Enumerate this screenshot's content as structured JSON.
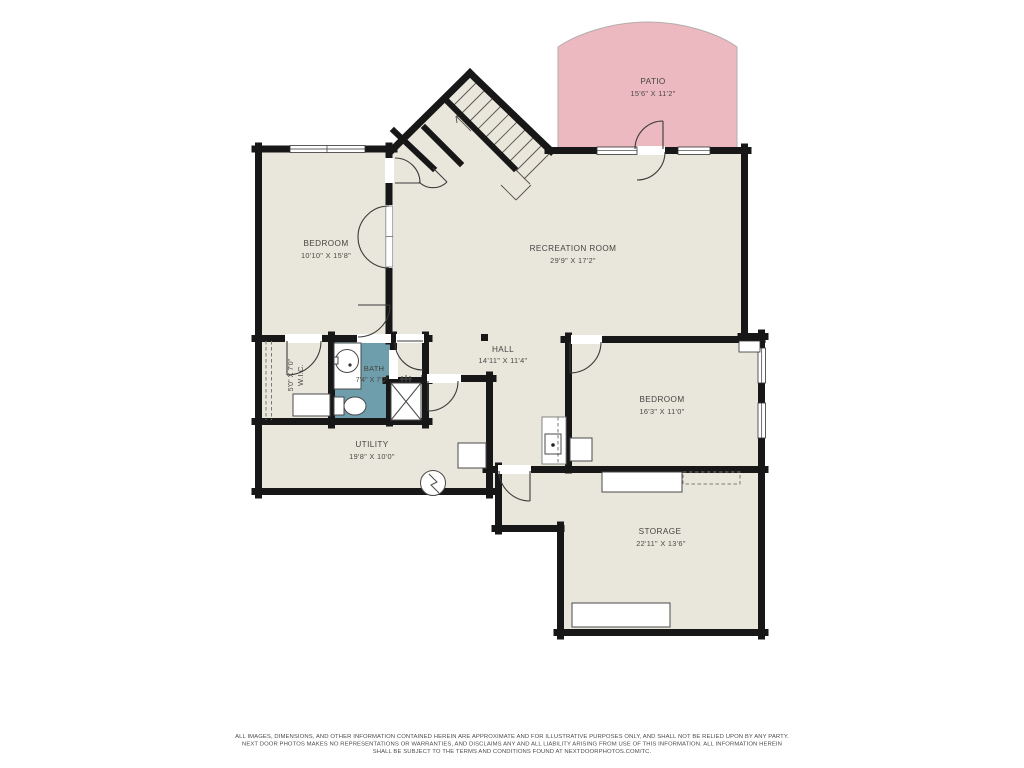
{
  "colors": {
    "wall": "#171717",
    "floor": "#e9e6dc",
    "patio": "#edb9c0",
    "bath": "#6e9eac",
    "line": "#3b3b3b"
  },
  "rooms": {
    "patio": {
      "name": "PATIO",
      "dims": "15'6\" X 11'2\""
    },
    "bedroom1": {
      "name": "BEDROOM",
      "dims": "10'10\" X 15'8\""
    },
    "recreation": {
      "name": "RECREATION ROOM",
      "dims": "29'9\" X 17'2\""
    },
    "hall": {
      "name": "HALL",
      "dims": "14'11\" X 11'4\""
    },
    "wic": {
      "name": "W.I.C.",
      "dims": "5'0\" X 7'0\""
    },
    "bath": {
      "name": "BATH",
      "dims": "7'4\" X 7'0\""
    },
    "utility": {
      "name": "UTILITY",
      "dims": "19'8\" X 10'0\""
    },
    "bedroom2": {
      "name": "BEDROOM",
      "dims": "16'3\" X 11'0\""
    },
    "storage": {
      "name": "STORAGE",
      "dims": "22'11\" X 13'6\""
    }
  },
  "disclaimer": {
    "lines": [
      "ALL IMAGES, DIMENSIONS, AND OTHER INFORMATION CONTAINED HEREIN ARE APPROXIMATE AND FOR ILLUSTRATIVE PURPOSES ONLY, AND SHALL NOT BE RELIED UPON BY ANY PARTY.",
      "NEXT DOOR PHOTOS MAKES NO REPRESENTATIONS OR WARRANTIES, AND DISCLAIMS ANY AND ALL LIABILITY ARISING FROM USE OF THIS INFORMATION. ALL INFORMATION HEREIN",
      "SHALL BE SUBJECT TO THE TERMS AND CONDITIONS FOUND AT NEXTDOORPHOTOS.COM/TC."
    ]
  }
}
